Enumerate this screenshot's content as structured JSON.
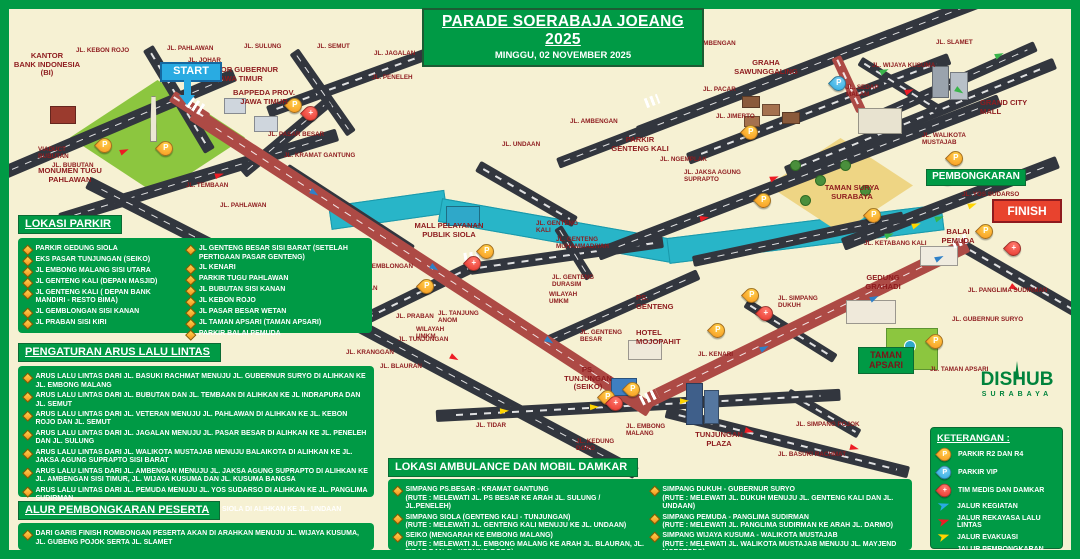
{
  "title": {
    "line1": "PARADE SOERABAJA JOEANG 2025",
    "line2": "MINGGU, 02 NOVEMBER 2025"
  },
  "colors": {
    "green": "#009a45",
    "cream": "#f6f1d3",
    "maroon": "#8e1b1e",
    "route_red": "#ad4a45",
    "road": "#32363e",
    "water": "#28b5c8",
    "blue": "#29abe2",
    "arrow_red": "#ed1c24",
    "arrow_yellow": "#ffd500",
    "arrow_green": "#39b54a"
  },
  "panels": {
    "parkir": {
      "header": "LOKASI PARKIR",
      "cols": [
        [
          "PARKIR GEDUNG SIOLA",
          "EKS PASAR TUNJUNGAN (SEIKO)",
          "JL EMBONG MALANG SISI UTARA",
          "JL GENTENG KALI (DEPAN MASJID)",
          "JL GENTENG KALI ( DEPAN BANK MANDIRI - RESTO BIMA)",
          "JL GEMBLONGAN SISI KANAN",
          "JL PRABAN SISI KIRI"
        ],
        [
          "JL GENTENG BESAR SISI BARAT (SETELAH PERTIGAAN PASAR GENTENG)",
          "JL KENARI",
          "PARKIR TUGU PAHLAWAN",
          "JL BUBUTAN SISI KANAN",
          "JL KEBON ROJO",
          "JL PASAR BESAR WETAN",
          "JL TAMAN APSARI (TAMAN APSARI)",
          "PARKIR BALAI PEMUDA"
        ]
      ]
    },
    "arus": {
      "header": "PENGATURAN ARUS LALU LINTAS",
      "items": [
        "ARUS LALU LINTAS DARI JL. BASUKI RACHMAT MENUJU JL. GUBERNUR SURYO DI ALIHKAN KE JL. EMBONG MALANG",
        "ARUS LALU LINTAS DARI JL. BUBUTAN DAN JL. TEMBAAN DI ALIHKAN KE JL INDRAPURA DAN JL. SEMUT",
        "ARUS LALU LINTAS DARI JL. VETERAN MENUJU JL. PAHLAWAN DI ALIHKAN KE JL. KEBON ROJO DAN JL. SEMUT",
        "ARUS LALU LINTAS DARI JL. JAGALAN MENUJU JL. PASAR BESAR DI ALIHKAN KE JL. PENELEH DAN JL. SULUNG",
        "ARUS LALU LINTAS DARI JL. WALIKOTA MUSTAJAB MENUJU BALAIKOTA DI ALIHKAN KE JL. JAKSA AGUNG SUPRAPTO SISI BARAT",
        "ARUS LALU LINTAS DARI JL. AMBENGAN MENUJU JL. JAKSA AGUNG SUPRAPTO DI ALIHKAN KE JL. AMBENGAN SISI TIMUR, JL. WIJAYA KUSUMA DAN JL. KUSUMA BANGSA",
        "ARUS LALU LINTAS DARI JL. PEMUDA MENUJU JL. YOS SUDARSO DI ALIHKAN KE JL. PANGLIMA SUDIRMAN",
        "ARUS LALU LINTAS DARI JL. GENTENG KALI MENUJU SIOLA DI ALIHKAN KE JL. UNDAAN"
      ]
    },
    "alur": {
      "header": "ALUR PEMBONGKARAN PESERTA",
      "items": [
        "DARI GARIS FINISH ROMBONGAN PESERTA AKAN DI ARAHKAN MENUJU JL. WIJAYA KUSUMA, JL. GUBENG POJOK SERTA JL. SLAMET"
      ]
    },
    "ambulance": {
      "header": "LOKASI AMBULANCE DAN MOBIL DAMKAR",
      "cols": [
        [
          {
            "name": "SIMPANG PS.BESAR - KRAMAT GANTUNG",
            "rute": "(RUTE : MELEWATI JL. PS BESAR KE ARAH JL. SULUNG / JL.PENELEH)"
          },
          {
            "name": "SIMPANG SIOLA (GENTENG KALI - TUNJUNGAN)",
            "rute": "(RUTE : MELEWATI JL. GENTENG KALI MENUJU KE JL. UNDAAN)"
          },
          {
            "name": "SEIKO (MENGARAH KE EMBONG MALANG)",
            "rute": "(RUTE : MELEWATI JL. EMBONG MALANG KE ARAH JL. BLAURAN, JL. TIDAR DAN JL. KEDUNG DORO)"
          }
        ],
        [
          {
            "name": "SIMPANG DUKUH - GUBERNUR SURYO",
            "rute": "(RUTE : MELEWATI JL. DUKUH MENUJU JL. GENTENG KALI DAN JL. UNDAAN)"
          },
          {
            "name": "SIMPANG PEMUDA - PANGLIMA SUDIRMAN",
            "rute": "(RUTE : MELEWATI JL. PANGLIMA SUDIRMAN KE ARAH JL. DARMO)"
          },
          {
            "name": "SIMPANG WIJAYA KUSUMA - WALIKOTA MUSTAJAB",
            "rute": "(RUTE : MELEWATI JL. WALIKOTA MUSTAJAB MENUJU JL. MAYJEND MOESTOPO)"
          }
        ]
      ]
    },
    "keterangan": {
      "header": "KETERANGAN :",
      "items": [
        {
          "icon": "pin-orange",
          "label": "PARKIR R2 DAN R4"
        },
        {
          "icon": "pin-blue",
          "label": "PARKIR VIP"
        },
        {
          "icon": "pin-red",
          "label": "TIM MEDIS DAN DAMKAR"
        },
        {
          "icon": "arrow-blue",
          "label": "JALUR KEGIATAN"
        },
        {
          "icon": "arrow-red",
          "label": "JALUR REKAYASA LALU LINTAS"
        },
        {
          "icon": "arrow-yellow",
          "label": "JALUR EVAKUASI"
        },
        {
          "icon": "arrow-green",
          "label": "JALUR PEMBONGKARAN PESERTA"
        }
      ]
    }
  },
  "map": {
    "markers": {
      "start": "START",
      "finish": "FINISH",
      "pembongkaran": "PEMBONGKARAN",
      "taman_apsari": "TAMAN\nAPSARI"
    },
    "logo": {
      "name": "DISHUB",
      "city": "SURABAYA"
    },
    "labels": [
      {
        "t": "JL. KEBON ROJO",
        "x": 76,
        "y": 47
      },
      {
        "t": "JL. PAHLAWAN",
        "x": 167,
        "y": 45
      },
      {
        "t": "JL. JOHAR",
        "x": 188,
        "y": 57
      },
      {
        "t": "JL. SULUNG",
        "x": 244,
        "y": 43
      },
      {
        "t": "JL. SEMUT",
        "x": 317,
        "y": 43
      },
      {
        "t": "JL. JAGALAN",
        "x": 374,
        "y": 50
      },
      {
        "t": "JL. PENELEH",
        "x": 372,
        "y": 74
      },
      {
        "t": "JL. PASAR BESAR",
        "x": 268,
        "y": 131
      },
      {
        "t": "JL. KRAMAT GANTUNG",
        "x": 284,
        "y": 152
      },
      {
        "t": "JL. UNDAAN",
        "x": 502,
        "y": 141
      },
      {
        "t": "JL. AMBENGAN",
        "x": 688,
        "y": 40
      },
      {
        "t": "JL. AMBENGAN",
        "x": 570,
        "y": 118
      },
      {
        "t": "JL. SLAMET",
        "x": 936,
        "y": 39
      },
      {
        "t": "JL. WIJAYA KUSUMA",
        "x": 872,
        "y": 62
      },
      {
        "t": "JL. PACAR",
        "x": 703,
        "y": 86
      },
      {
        "t": "JL. SEDAP\nMALAM",
        "x": 846,
        "y": 84
      },
      {
        "t": "JL. JIMERTO",
        "x": 716,
        "y": 113
      },
      {
        "t": "JL. NGEMPLAK",
        "x": 660,
        "y": 156
      },
      {
        "t": "JL. JAKSA AGUNG\nSUPRAPTO",
        "x": 684,
        "y": 169
      },
      {
        "t": "JL. WALIKOTA\nMUSTAJAB",
        "x": 922,
        "y": 132
      },
      {
        "t": "JL. KETABANG KALI",
        "x": 864,
        "y": 240
      },
      {
        "t": "JL. SIMPANG\nDUKUH",
        "x": 778,
        "y": 295
      },
      {
        "t": "JL. PANGLIMA SUDIRMAN",
        "x": 968,
        "y": 287
      },
      {
        "t": "JL. GUBERNUR SURYO",
        "x": 952,
        "y": 316
      },
      {
        "t": "JL. TAMAN APSARI",
        "x": 930,
        "y": 366
      },
      {
        "t": "JL. YOS SUDARSO",
        "x": 962,
        "y": 191
      },
      {
        "t": "JL. SIMPANG POJOK",
        "x": 796,
        "y": 421
      },
      {
        "t": "JL. BASUKI RACHMAT",
        "x": 778,
        "y": 451
      },
      {
        "t": "JL. KENARI",
        "x": 698,
        "y": 351
      },
      {
        "t": "JL. GENTENG\nKALI",
        "x": 536,
        "y": 220
      },
      {
        "t": "JL. GENTENG\nMUHAMMADIYAH",
        "x": 556,
        "y": 236
      },
      {
        "t": "JL. GENTENG\nDURASIM",
        "x": 552,
        "y": 274
      },
      {
        "t": "WILAYAH\nUMKM",
        "x": 549,
        "y": 291
      },
      {
        "t": "JL. GENTENG\nBESAR",
        "x": 580,
        "y": 329
      },
      {
        "t": "JL. GEMBLONGAN",
        "x": 356,
        "y": 263
      },
      {
        "t": "JL. BUBUTAN",
        "x": 336,
        "y": 285
      },
      {
        "t": "JL. PRABAN",
        "x": 396,
        "y": 313
      },
      {
        "t": "JL. TANJUNG\nANOM",
        "x": 438,
        "y": 310
      },
      {
        "t": "WILAYAH\nUMKM",
        "x": 416,
        "y": 326
      },
      {
        "t": "JL. TUNJUNGAN",
        "x": 398,
        "y": 336
      },
      {
        "t": "JL. KRANGGAN",
        "x": 346,
        "y": 349
      },
      {
        "t": "JL. BLAURAN",
        "x": 380,
        "y": 363
      },
      {
        "t": "JL. TIDAR",
        "x": 476,
        "y": 422
      },
      {
        "t": "JL. KEDUNG\nDORO",
        "x": 576,
        "y": 438
      },
      {
        "t": "JL. EMBONG\nMALANG",
        "x": 626,
        "y": 423
      },
      {
        "t": "JL. TEMBAAN",
        "x": 186,
        "y": 182
      },
      {
        "t": "JL. PAHLAWAN",
        "x": 220,
        "y": 202
      },
      {
        "t": "VIADUCT\nBUBUTAN",
        "x": 38,
        "y": 146
      },
      {
        "t": "JL. BUBUTAN",
        "x": 52,
        "y": 162
      },
      {
        "t": "KANTOR\nBANK INDONESIA\n(BI)",
        "x": 8,
        "y": 52,
        "w": 78,
        "l": 1,
        "c": 1
      },
      {
        "t": "KANTOR GUBERNUR\nJAWA TIMUR",
        "x": 196,
        "y": 66,
        "w": 86,
        "l": 1,
        "c": 1
      },
      {
        "t": "BAPPEDA PROV.\nJAWA TIMUR",
        "x": 226,
        "y": 89,
        "w": 76,
        "l": 1,
        "c": 1
      },
      {
        "t": "MONUMEN TUGU\nPAHLAWAN",
        "x": 24,
        "y": 167,
        "w": 92,
        "l": 1,
        "c": 1
      },
      {
        "t": "GRAHA\nSAWUNGGALING",
        "x": 722,
        "y": 59,
        "w": 88,
        "l": 1,
        "c": 1
      },
      {
        "t": "GRAND CITY\nMALL",
        "x": 980,
        "y": 99,
        "w": 70,
        "l": 1
      },
      {
        "t": "PARKIR\nGENTENG KALI",
        "x": 600,
        "y": 136,
        "w": 80,
        "l": 1,
        "c": 1
      },
      {
        "t": "TAMAN SURYA\nSURABAYA",
        "x": 812,
        "y": 184,
        "w": 80,
        "l": 1,
        "c": 1
      },
      {
        "t": "BALAI\nPEMUDA",
        "x": 930,
        "y": 228,
        "w": 56,
        "l": 1,
        "c": 1
      },
      {
        "t": "GEDUNG\nGRAHADI",
        "x": 852,
        "y": 274,
        "w": 62,
        "l": 1,
        "c": 1
      },
      {
        "t": "MALL PELAYANAN\nPUBLIK SIOLA",
        "x": 400,
        "y": 222,
        "w": 98,
        "l": 1,
        "c": 1
      },
      {
        "t": "PS.\nGENTENG",
        "x": 636,
        "y": 294,
        "w": 50,
        "l": 1
      },
      {
        "t": "HOTEL\nMOJOPAHIT",
        "x": 636,
        "y": 329,
        "w": 60,
        "l": 1
      },
      {
        "t": "PS.\nTUNJUNGAN\n(SEIKO)",
        "x": 556,
        "y": 366,
        "w": 64,
        "l": 1,
        "c": 1
      },
      {
        "t": "TUNJUNGAN\nPLAZA",
        "x": 684,
        "y": 431,
        "w": 70,
        "l": 1,
        "c": 1
      }
    ],
    "pins": [
      {
        "k": "o",
        "x": 97,
        "y": 138
      },
      {
        "k": "o",
        "x": 158,
        "y": 141
      },
      {
        "k": "o",
        "x": 287,
        "y": 98
      },
      {
        "k": "o",
        "x": 479,
        "y": 244
      },
      {
        "k": "o",
        "x": 419,
        "y": 279
      },
      {
        "k": "o",
        "x": 743,
        "y": 125
      },
      {
        "k": "o",
        "x": 756,
        "y": 193
      },
      {
        "k": "o",
        "x": 948,
        "y": 151
      },
      {
        "k": "o",
        "x": 866,
        "y": 208
      },
      {
        "k": "o",
        "x": 744,
        "y": 288
      },
      {
        "k": "o",
        "x": 710,
        "y": 323
      },
      {
        "k": "o",
        "x": 978,
        "y": 224
      },
      {
        "k": "o",
        "x": 928,
        "y": 334
      },
      {
        "k": "o",
        "x": 625,
        "y": 382
      },
      {
        "k": "o",
        "x": 600,
        "y": 390
      },
      {
        "k": "b",
        "x": 831,
        "y": 76
      },
      {
        "k": "r",
        "x": 303,
        "y": 106
      },
      {
        "k": "r",
        "x": 466,
        "y": 256
      },
      {
        "k": "r",
        "x": 608,
        "y": 396
      },
      {
        "k": "r",
        "x": 758,
        "y": 306
      },
      {
        "k": "r",
        "x": 1006,
        "y": 241
      },
      {
        "k": "r",
        "x": 940,
        "y": 170
      }
    ],
    "arrows": [
      {
        "c": "blue",
        "x": 310,
        "y": 190,
        "r": 33
      },
      {
        "c": "blue",
        "x": 430,
        "y": 265,
        "r": 33
      },
      {
        "c": "blue",
        "x": 545,
        "y": 338,
        "r": 33
      },
      {
        "c": "blue",
        "x": 760,
        "y": 345,
        "r": -26
      },
      {
        "c": "blue",
        "x": 870,
        "y": 295,
        "r": -26
      },
      {
        "c": "blue",
        "x": 935,
        "y": 255,
        "r": -26
      },
      {
        "c": "red",
        "x": 120,
        "y": 148,
        "r": -23
      },
      {
        "c": "red",
        "x": 215,
        "y": 172,
        "r": -17
      },
      {
        "c": "red",
        "x": 320,
        "y": 300,
        "r": 28
      },
      {
        "c": "red",
        "x": 450,
        "y": 355,
        "r": 28
      },
      {
        "c": "red",
        "x": 700,
        "y": 215,
        "r": -12
      },
      {
        "c": "red",
        "x": 770,
        "y": 175,
        "r": -21
      },
      {
        "c": "red",
        "x": 660,
        "y": 52,
        "r": -21
      },
      {
        "c": "red",
        "x": 905,
        "y": 88,
        "r": -22
      },
      {
        "c": "red",
        "x": 1010,
        "y": 285,
        "r": 30
      },
      {
        "c": "red",
        "x": 745,
        "y": 428,
        "r": 14
      },
      {
        "c": "red",
        "x": 850,
        "y": 445,
        "r": 14
      },
      {
        "c": "yellow",
        "x": 500,
        "y": 408,
        "r": -3
      },
      {
        "c": "yellow",
        "x": 590,
        "y": 404,
        "r": -3
      },
      {
        "c": "yellow",
        "x": 680,
        "y": 398,
        "r": -3
      },
      {
        "c": "yellow",
        "x": 912,
        "y": 222,
        "r": -21
      },
      {
        "c": "yellow",
        "x": 968,
        "y": 202,
        "r": -21
      },
      {
        "c": "green",
        "x": 885,
        "y": 232,
        "r": -21
      },
      {
        "c": "green",
        "x": 935,
        "y": 215,
        "r": -21
      },
      {
        "c": "green",
        "x": 880,
        "y": 68,
        "r": -24
      },
      {
        "c": "green",
        "x": 955,
        "y": 88,
        "r": 32
      },
      {
        "c": "green",
        "x": 995,
        "y": 52,
        "r": -24
      }
    ]
  }
}
